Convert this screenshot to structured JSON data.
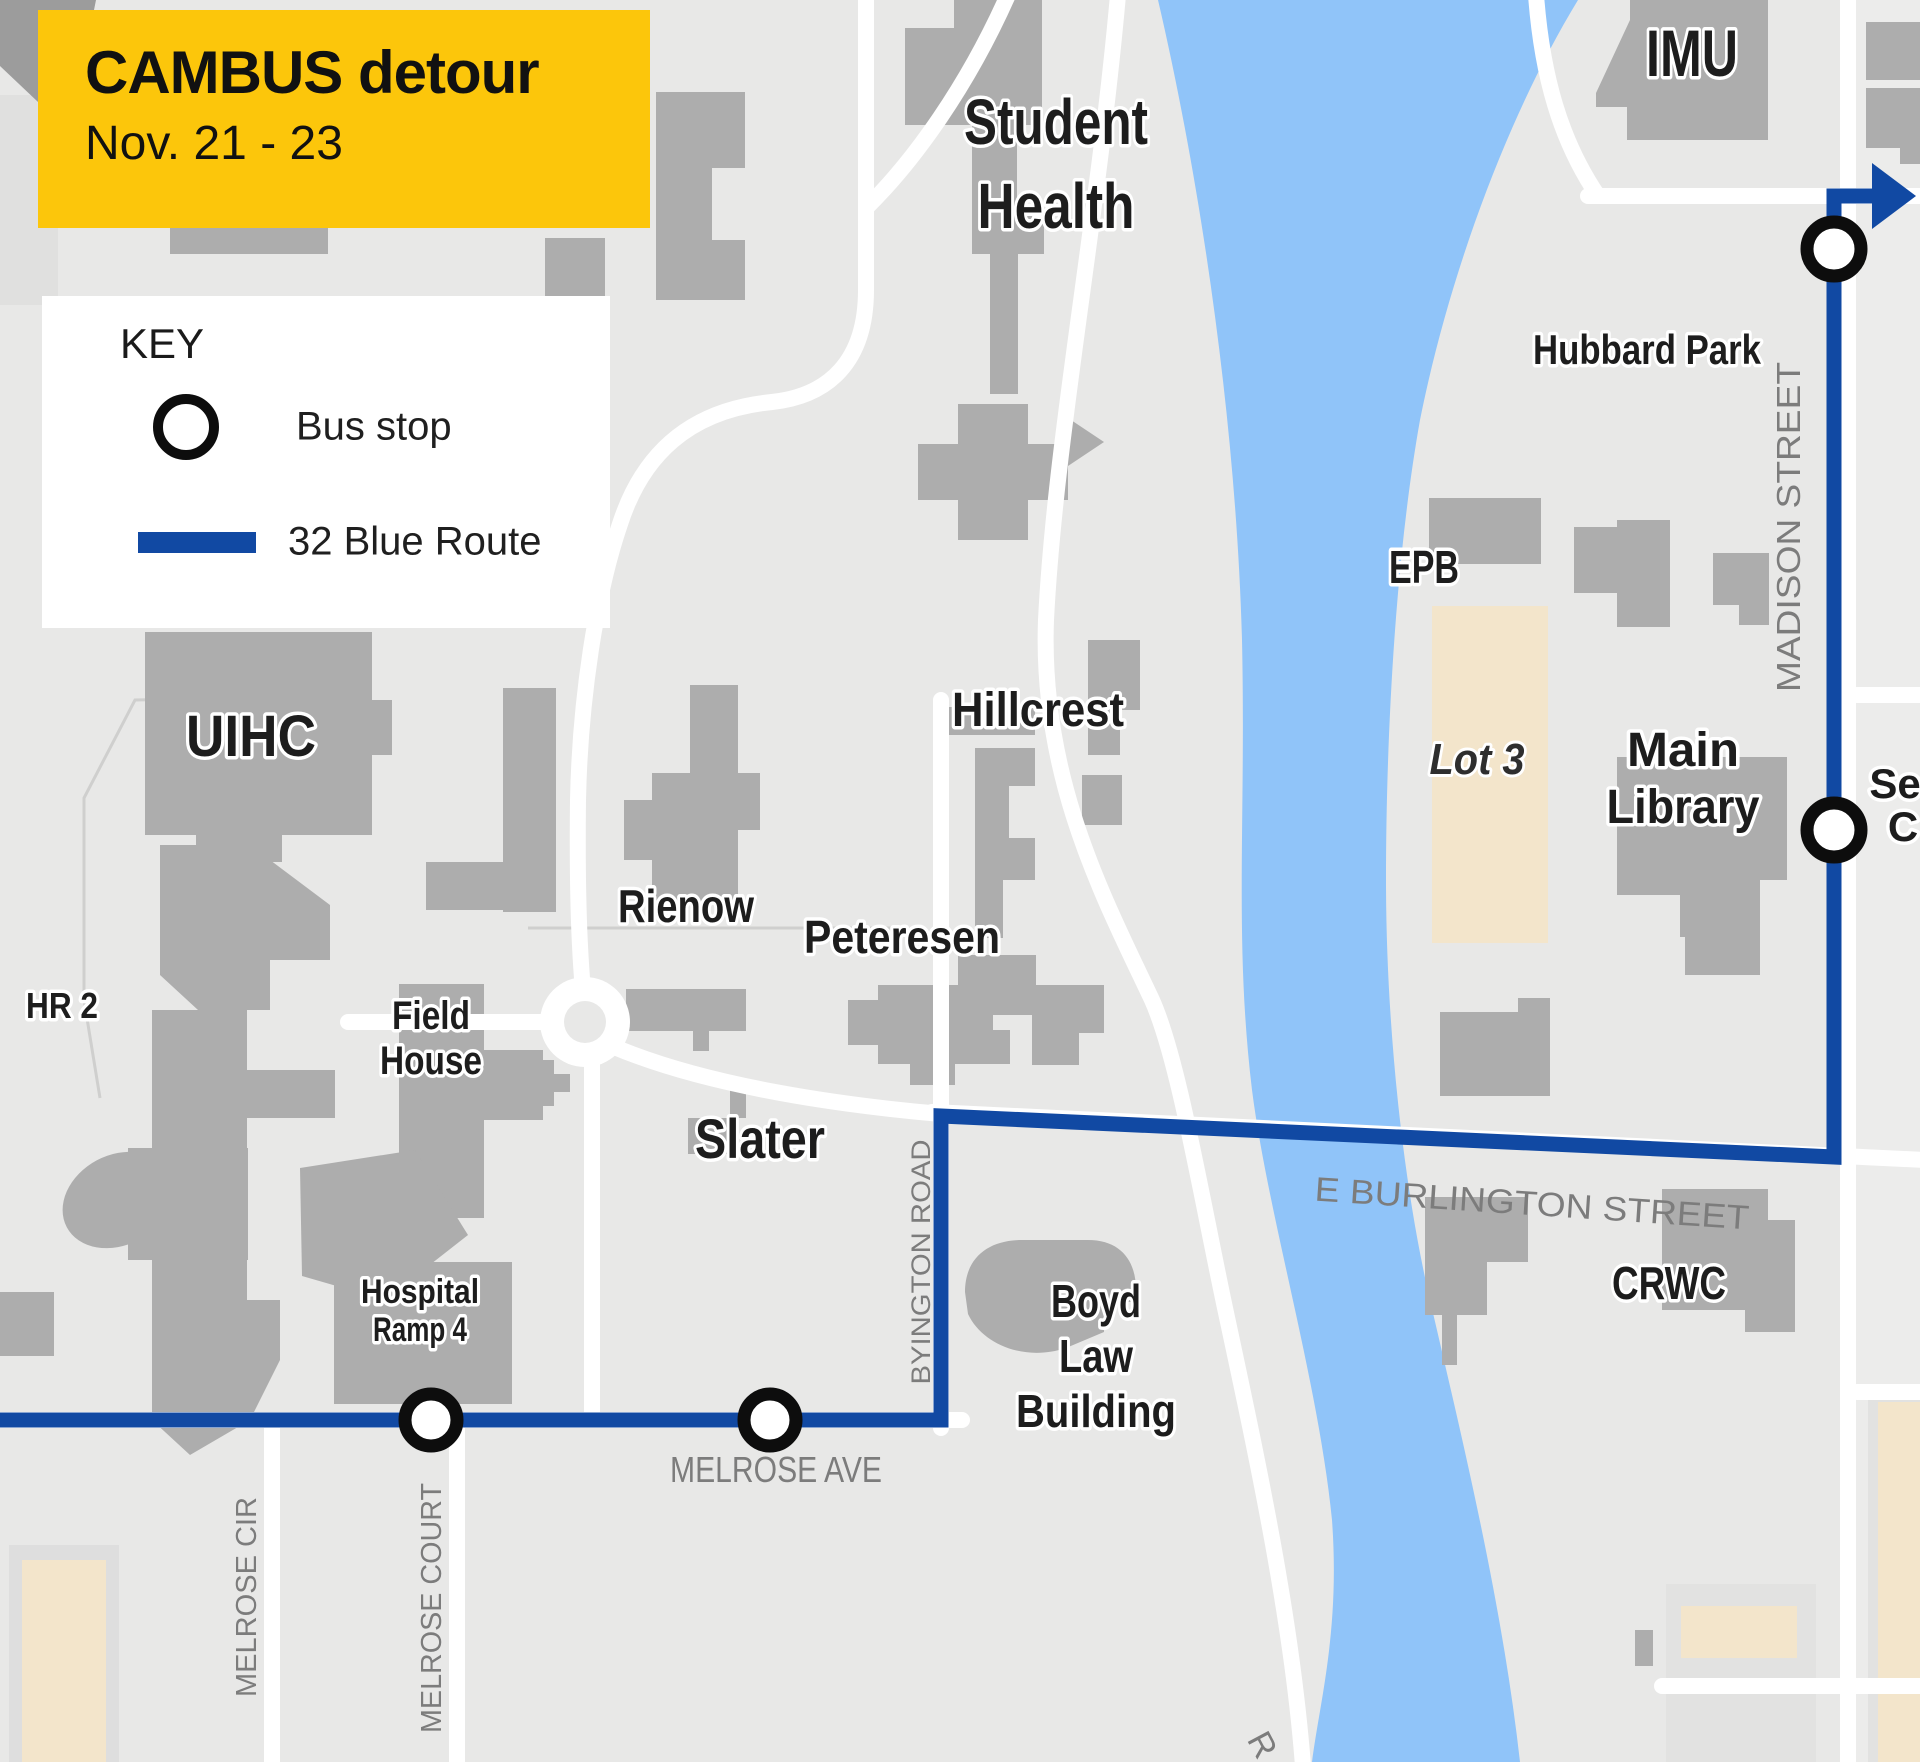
{
  "banner": {
    "title": "CAMBUS detour",
    "date_range": "Nov. 21 - 23"
  },
  "key": {
    "title": "KEY",
    "bus_stop_label": "Bus stop",
    "route_label": "32 Blue Route"
  },
  "route": {
    "name": "32 Blue Route",
    "color": "#1149A3",
    "bus_stop_count": 4
  },
  "colors": {
    "banner_bg": "#FCC60B",
    "route_blue": "#1149A3",
    "river_blue": "#90C4F9",
    "building_gray": "#ADADAD",
    "map_bg": "#E8E8E7",
    "road_white": "#FFFFFF",
    "parking_tan": "#F3E5CB",
    "street_label_gray": "#7C7C7C",
    "bus_stop_ring": "#0D0D0D"
  },
  "map": {
    "labels": {
      "imu": "IMU",
      "student_health_1": "Student",
      "student_health_2": "Health",
      "hubbard_park": "Hubbard Park",
      "epb": "EPB",
      "lot3": "Lot 3",
      "main_library_1": "Main",
      "main_library_2": "Library",
      "seamans_partial_1": "Se",
      "seamans_partial_2": "C",
      "uihc": "UIHC",
      "hillcrest": "Hillcrest",
      "rienow": "Rienow",
      "peteresen": "Peteresen",
      "hr2": "HR 2",
      "field_house_1": "Field",
      "field_house_2": "House",
      "slater": "Slater",
      "hospital_ramp_1": "Hospital",
      "hospital_ramp_2": "Ramp 4",
      "boyd_1": "Boyd",
      "boyd_2": "Law",
      "boyd_3": "Building",
      "crwc": "CRWC"
    },
    "streets": {
      "madison": "MADISON STREET",
      "e_burlington": "E BURLINGTON STREET",
      "byington": "BYINGTON ROAD",
      "melrose_ave": "MELROSE AVE",
      "melrose_cir": "MELROSE CIR",
      "melrose_court": "MELROSE COURT",
      "diagonal_partial": "R"
    }
  }
}
